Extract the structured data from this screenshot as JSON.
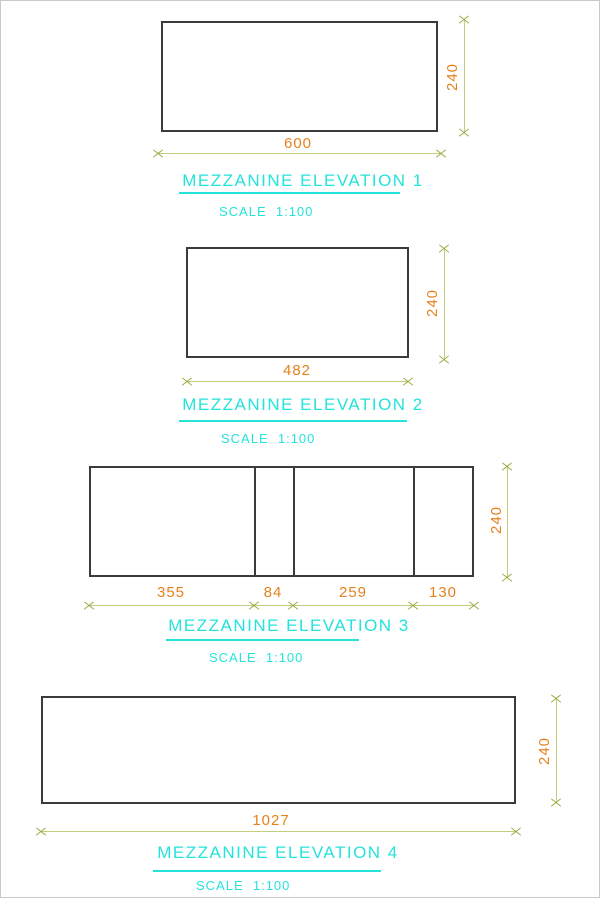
{
  "colors": {
    "title": "#24e3db",
    "dim-text": "#e6811c",
    "dim-line": "#c6cc7d",
    "tick": "#9cab43",
    "outline": "#3b3b3b",
    "page-border": "#c9c9c9"
  },
  "elevations": [
    {
      "title": "MEZZANINE ELEVATION 1",
      "scale": "SCALE  1:100",
      "width": "600",
      "height": "240"
    },
    {
      "title": "MEZZANINE ELEVATION 2",
      "scale": "SCALE  1:100",
      "width": "482",
      "height": "240"
    },
    {
      "title": "MEZZANINE ELEVATION 3",
      "scale": "SCALE  1:100",
      "height": "240",
      "segments": [
        "355",
        "84",
        "259",
        "130"
      ]
    },
    {
      "title": "MEZZANINE ELEVATION 4",
      "scale": "SCALE  1:100",
      "width": "1027",
      "height": "240"
    }
  ]
}
